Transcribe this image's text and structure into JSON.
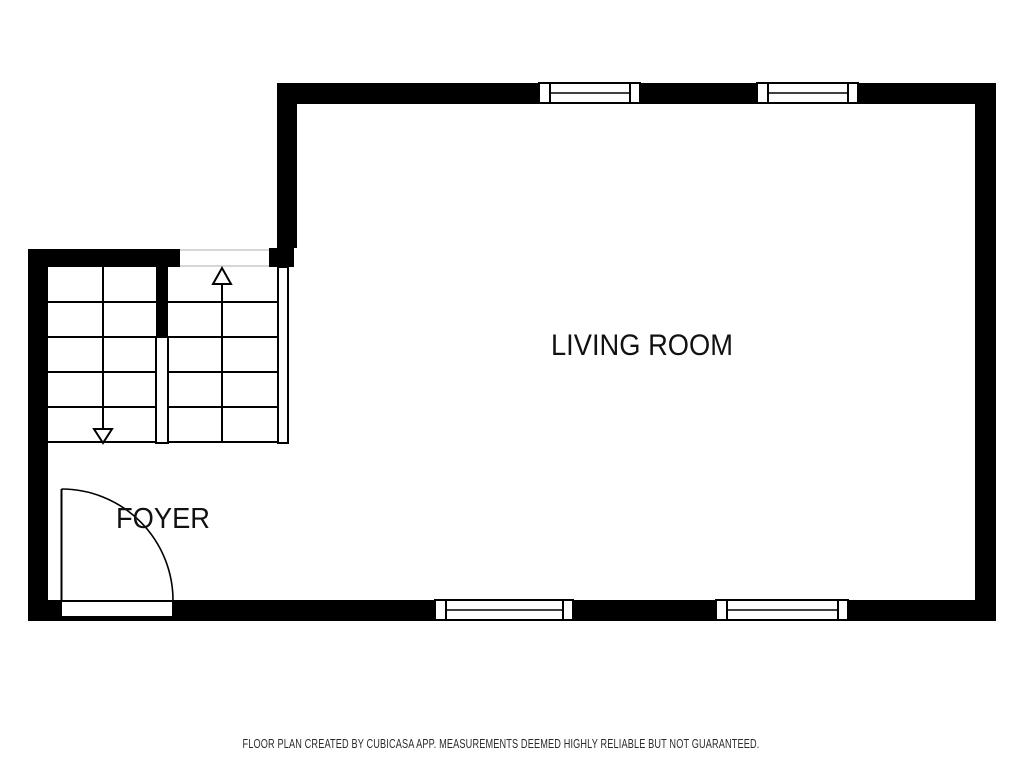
{
  "floor_plan": {
    "title": "First floor plan",
    "rooms": {
      "living_room": {
        "label": "LIVING ROOM"
      },
      "foyer": {
        "label": "FOYER"
      }
    },
    "stairs": {
      "up_arrow_icon": "stairs-up-arrow-icon",
      "down_arrow_icon": "stairs-down-arrow-icon",
      "left_flight_steps": 5,
      "right_flight_steps": 4
    },
    "features": {
      "top_windows": 2,
      "bottom_windows": 2,
      "entry_doors": 1
    },
    "colors": {
      "wall": "#000000",
      "background": "#ffffff",
      "room_label_text": "#111111",
      "footer_text": "#2b2b2b",
      "opening_gap_line": "#c8c8c8"
    }
  },
  "footer": {
    "disclaimer": "FLOOR PLAN CREATED BY CUBICASA APP. MEASUREMENTS DEEMED HIGHLY RELIABLE BUT NOT GUARANTEED."
  }
}
